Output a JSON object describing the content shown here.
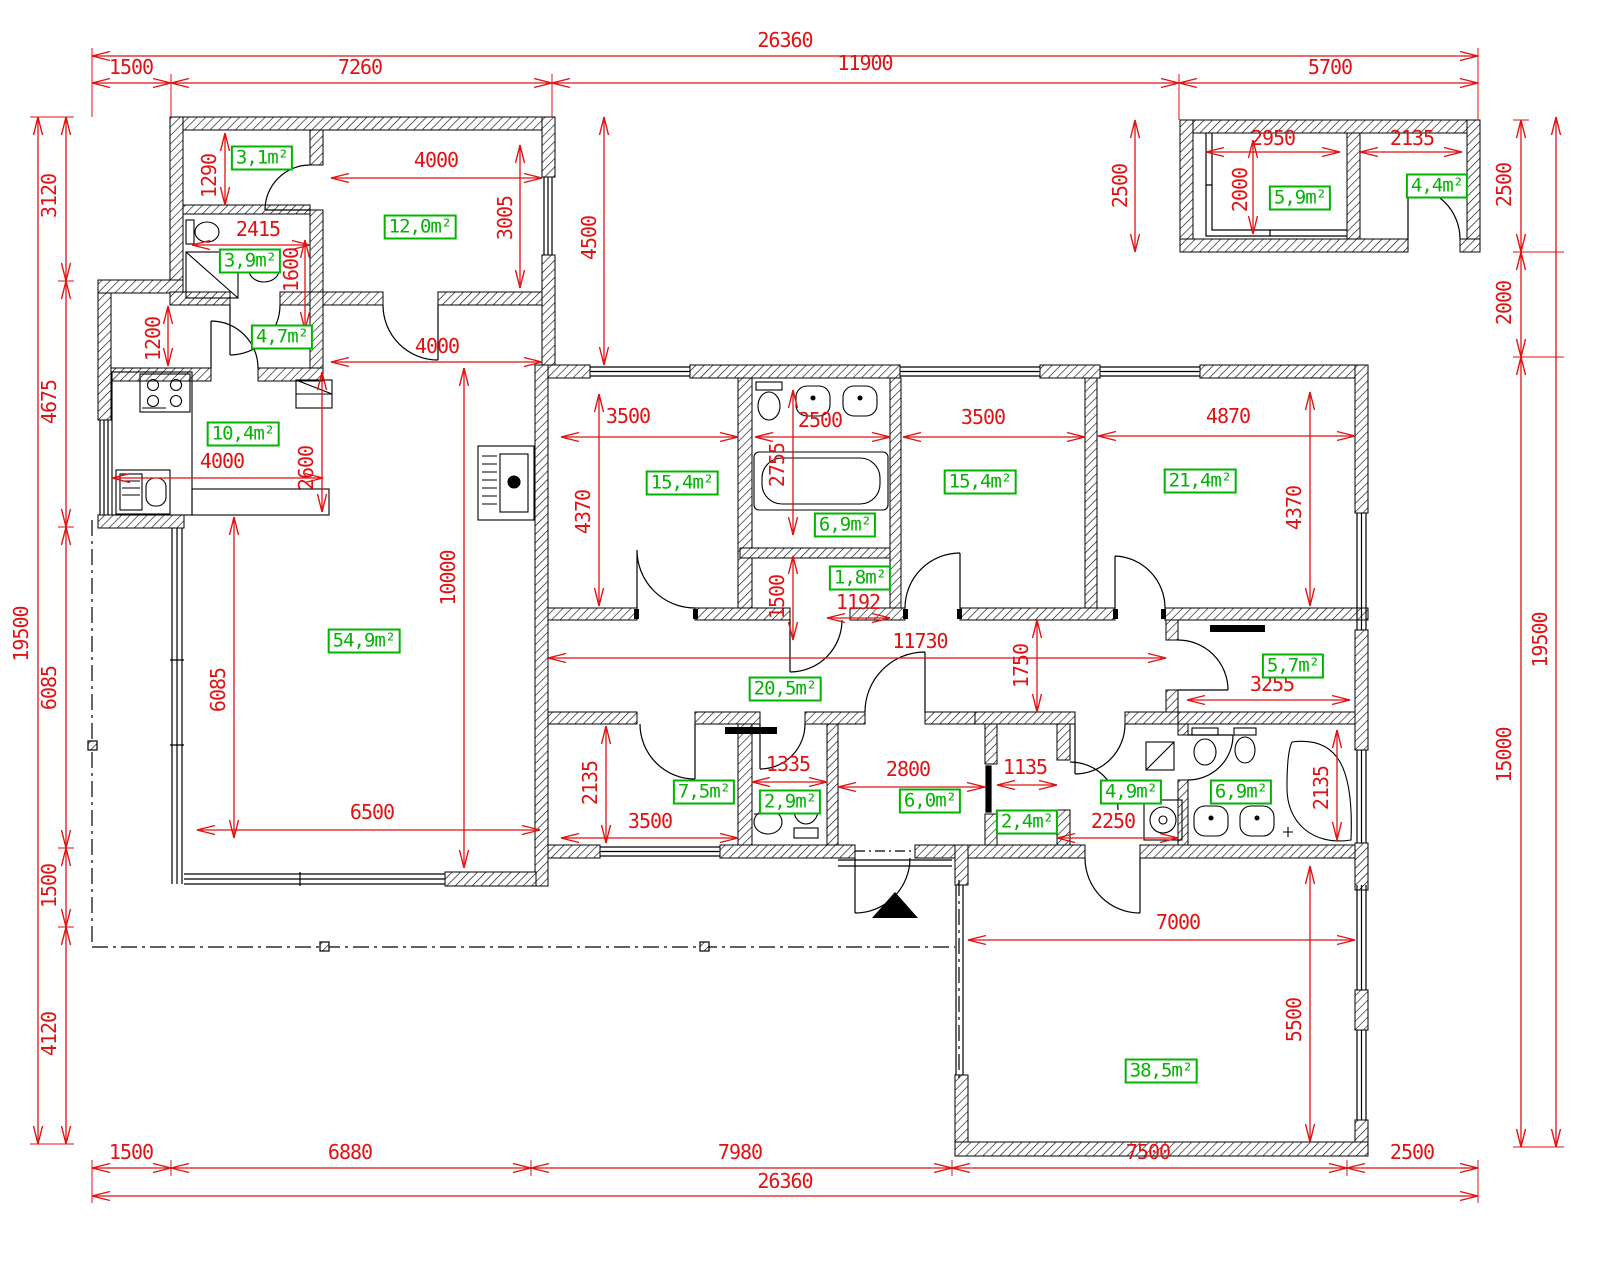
{
  "drawing": {
    "kind": "architectural floor plan",
    "units": "mm"
  },
  "colors": {
    "dimension": "#e01212",
    "area_label": "#00b400",
    "wall": "#000000"
  },
  "dims": {
    "top_total": "26360",
    "top_1500": "1500",
    "top_7260": "7260",
    "top_11900": "11900",
    "top_5700": "5700",
    "bottom_1500": "1500",
    "bottom_6880": "6880",
    "bottom_7980": "7980",
    "bottom_7500": "7500",
    "bottom_2500": "2500",
    "bottom_total": "26360",
    "left_3120": "3120",
    "left_4675": "4675",
    "left_6085": "6085",
    "left_1500": "1500",
    "left_4120": "4120",
    "left_total": "19500",
    "right_2500": "2500",
    "right_2000": "2000",
    "right_15000": "15000",
    "right_total": "19500",
    "annex_2950": "2950",
    "annex_2000": "2000",
    "annex_2135": "2135",
    "annex_2500": "2500",
    "block_1290": "1290",
    "block_4000": "4000",
    "block_3005": "3005",
    "block_4500": "4500",
    "block_2415": "2415",
    "block_1600": "1600",
    "hall_1200": "1200",
    "hall_4000": "4000",
    "kitchen_2600": "2600",
    "kitchen_4000": "4000",
    "living_10000": "10000",
    "living_6085": "6085",
    "living_6500": "6500",
    "bed1_3500": "3500",
    "bed1_4370": "4370",
    "bath_2500": "2500",
    "bath_2755": "2755",
    "closet_1500": "1500",
    "closet_1192": "1192",
    "bed2_3500": "3500",
    "bed3_4870": "4870",
    "bed3_4370": "4370",
    "corridor_11730": "11730",
    "corridor_1750": "1750",
    "room57_3255": "3255",
    "room75_2135": "2135",
    "room75_3500": "3500",
    "wc_1335": "1335",
    "vest_2800": "2800",
    "room24_1135": "1135",
    "hall49_2250": "2250",
    "bath2_2135": "2135",
    "garage_7000": "7000",
    "garage_5500": "5500"
  },
  "areas": {
    "pantry": "3,1m²",
    "room12": "12,0m²",
    "bath1": "3,9m²",
    "hall": "4,7m²",
    "kitchen": "10,4m²",
    "living": "54,9m²",
    "bed1": "15,4m²",
    "bath2": "6,9m²",
    "closet": "1,8m²",
    "bed2": "15,4m²",
    "bed3": "21,4m²",
    "room57": "5,7m²",
    "corridor": "20,5m²",
    "room75": "7,5m²",
    "wc": "2,9m²",
    "vestibule": "6,0m²",
    "room24": "2,4m²",
    "hall2": "4,9m²",
    "bath3": "6,9m²",
    "garage": "38,5m²",
    "annex_a": "5,9m²",
    "annex_b": "4,4m²"
  }
}
